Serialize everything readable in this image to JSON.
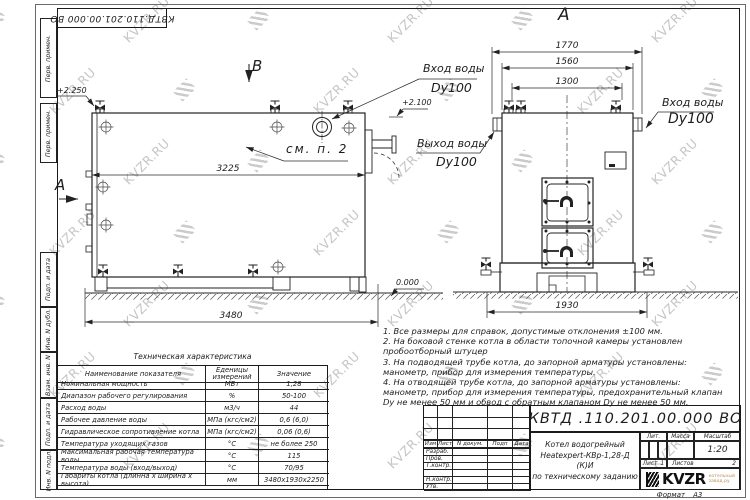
{
  "watermark": {
    "text": "KVZR.RU"
  },
  "frame": {
    "top_stamp": "КВТД.110.201.00.000  ВО",
    "side_labels": [
      "Перв. примен.",
      "Перв. примен.",
      "Подп. и дата",
      "Инв. N дубл.",
      "Взам. инв. N",
      "Подп. и дата",
      "Инв. N подл."
    ],
    "format_label": "Формат",
    "format_value": "А3"
  },
  "views": {
    "left": {
      "section_marker": "В",
      "view_marker": "А",
      "elev_top": "+2.250",
      "elev_zero": "0.000",
      "dim_shell": "3225",
      "dim_total": "3480",
      "see_note": "см. п. 2",
      "inlet_label": "Вход воды",
      "inlet_dn": "Dy100",
      "outlet_label": "Выход воды",
      "outlet_dn": "Dy100"
    },
    "right": {
      "view_title": "А",
      "dim_overall": "1770",
      "dim_body": "1560",
      "dim_nozzles": "1300",
      "dim_base": "1930",
      "elev_flange": "+2.100",
      "inlet_label": "Вход воды",
      "inlet_dn": "Dy100"
    }
  },
  "notes": {
    "lines": [
      "1.  Все размеры для справок, допустимые отклонения  ±100 мм.",
      "2.  На боковой стенке котла в области топочной камеры установлен",
      "пробоотборный штуцер",
      "3.  На подводящей трубе котла, до запорной арматуры установлены:",
      "манометр, прибор для измерения температуры.",
      "4.  На отводящей трубе котла, до запорной арматуры установлены:",
      "манометр, прибор для измерения температуры, предохранительный клапан",
      "Dу не менее 50 мм и обвод с обратным клапаном  Dу не менее 50 мм."
    ]
  },
  "spec_table": {
    "title": "Техническая характеристика",
    "headers": [
      "Наименование показателя",
      "Еденицы измерений",
      "Значение"
    ],
    "rows": [
      [
        "Номинальная мощность",
        "МВт",
        "1,28"
      ],
      [
        "Диапазон рабочего регулирования",
        "%",
        "50-100"
      ],
      [
        "Расход воды",
        "м3/ч",
        "44"
      ],
      [
        "Рабочее давление воды",
        "МПа (кгс/см2)",
        "0,6 (6,0)"
      ],
      [
        "Гидравлическое сопротивление котла",
        "МПа (кгс/см2)",
        "0,06 (0,6)"
      ],
      [
        "Температура уходящих газов",
        "°С",
        "не более 250"
      ],
      [
        "Максимальная рабочая температура воды",
        "°С",
        "115"
      ],
      [
        "Температура воды (вход/выход)",
        "°С",
        "70/95"
      ],
      [
        "Габариты котла (длинна х ширина х высота)",
        "мм",
        "3480х1930х2250"
      ]
    ]
  },
  "title_block": {
    "doc_number": "КВТД .110.201.00.000  ВО",
    "product_lines": [
      "Котел водогрейный",
      "Heatexpert-КВр-1,28-Д  (К)И",
      "по техническому заданию"
    ],
    "rev_headers": [
      "Изм",
      "Лист",
      "N докум.",
      "Подп",
      "Дата"
    ],
    "sign_labels": [
      "Разраб.",
      "Пров.",
      "Т.контр.",
      "",
      "Н.контр.",
      "Утв."
    ],
    "lit_label": "Лит.",
    "mass_label": "Масса",
    "scale_label": "Масштаб",
    "scale_value": "1:20",
    "sheet_label": "Лист",
    "sheet_value": "1",
    "sheets_label": "Листов",
    "sheets_value": "2",
    "logo_text": "KVZR",
    "logo_caption_1": "котельный",
    "logo_caption_2": "завод.ру"
  }
}
